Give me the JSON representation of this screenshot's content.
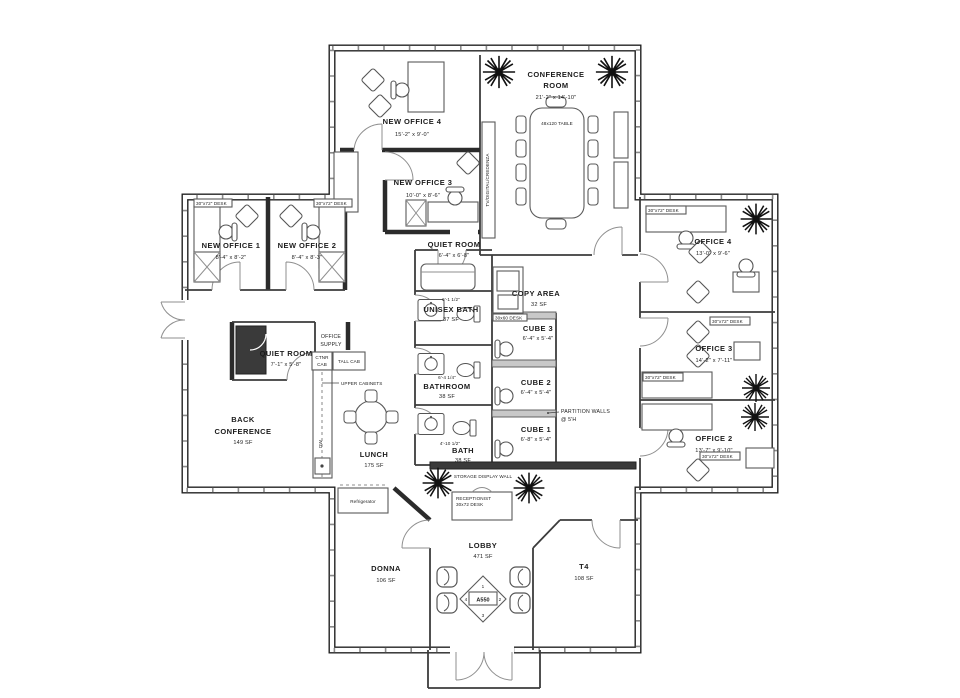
{
  "rooms": {
    "new_office_4": {
      "name": "NEW OFFICE 4",
      "dims": "15'-2\" x 9'-0\""
    },
    "new_office_3": {
      "name": "NEW OFFICE 3",
      "dims": "10'-0\" x 8'-6\""
    },
    "conference_room": {
      "name1": "CONFERENCE",
      "name2": "ROOM",
      "dims": "21'-2\" x 14'-10\""
    },
    "new_office_1": {
      "name": "NEW OFFICE 1",
      "dims": "8'-4\" x 8'-2\""
    },
    "new_office_2": {
      "name": "NEW OFFICE 2",
      "dims": "8'-4\" x 8'-3\""
    },
    "quiet_room_center": {
      "name": "QUIET ROOM",
      "dims": "6'-4\" x 6'-8\""
    },
    "quiet_room_left": {
      "name": "QUIET ROOM",
      "dims": "7'-1\" x 5'-8\""
    },
    "office_supply": {
      "name1": "OFFICE",
      "name2": "SUPPLY"
    },
    "back_conference": {
      "name1": "BACK",
      "name2": "CONFERENCE",
      "area": "149 SF"
    },
    "lunch": {
      "name": "LUNCH",
      "area": "175 SF"
    },
    "unisex_bath": {
      "name": "UNISEX BATH",
      "area": "37 SF"
    },
    "bathroom": {
      "name": "BATHROOM",
      "area": "38 SF"
    },
    "bath": {
      "name": "BATH",
      "area": "38 SF"
    },
    "copy_area": {
      "name": "COPY AREA",
      "area": "32 SF"
    },
    "cube_3": {
      "name": "CUBE 3",
      "dims": "6'-4\" x 5'-4\""
    },
    "cube_2": {
      "name": "CUBE 2",
      "dims": "6'-4\" x 5'-4\""
    },
    "cube_1": {
      "name": "CUBE 1",
      "dims": "6'-8\" x 5'-4\""
    },
    "office_4": {
      "name": "OFFICE 4",
      "dims": "13'-0\" x 9'-6\""
    },
    "office_3": {
      "name": "OFFICE 3",
      "dims": "14'-2\" x 7'-11\""
    },
    "office_2": {
      "name": "OFFICE 2",
      "dims": "13'-7\" x 9'-10\""
    },
    "donna": {
      "name": "DONNA",
      "area": "106 SF"
    },
    "lobby": {
      "name": "LOBBY",
      "area": "471 SF"
    },
    "t4": {
      "name": "T4",
      "area": "108 SF"
    }
  },
  "annotations": {
    "partition1": "PARTITION WALLS",
    "partition2": "@ 5'H",
    "storage_wall": "STORAGE DISPLAY WALL",
    "tv_credenza": "TV/DIGITAL/CREDENZA",
    "refrigerator": "Refrigerator",
    "upper_cabinets": "UPPER CABINETS",
    "cntr_cab1": "CTNR",
    "cntr_cab2": "CAB",
    "tall_cab": "TALL CAB",
    "dw": "DW",
    "reception1": "RECEPTIONIST",
    "reception2": "30x72 DESK",
    "conf_table": "48x120 TABLE",
    "desk_label": "30\"x72\" DESK",
    "desk_label_small": "30x60 DESK",
    "dim_unisex": "6'-1 1/2\"",
    "dim_bathroom": "6'-4 1/4\"",
    "dim_bath": "4'-10 1/2\""
  },
  "marker": {
    "id": "A550",
    "n1": "1",
    "n2": "2",
    "n3": "3",
    "n4": "4"
  },
  "colors": {
    "wall": "#222222",
    "partition": "#c8c8c8",
    "background": "#ffffff"
  }
}
